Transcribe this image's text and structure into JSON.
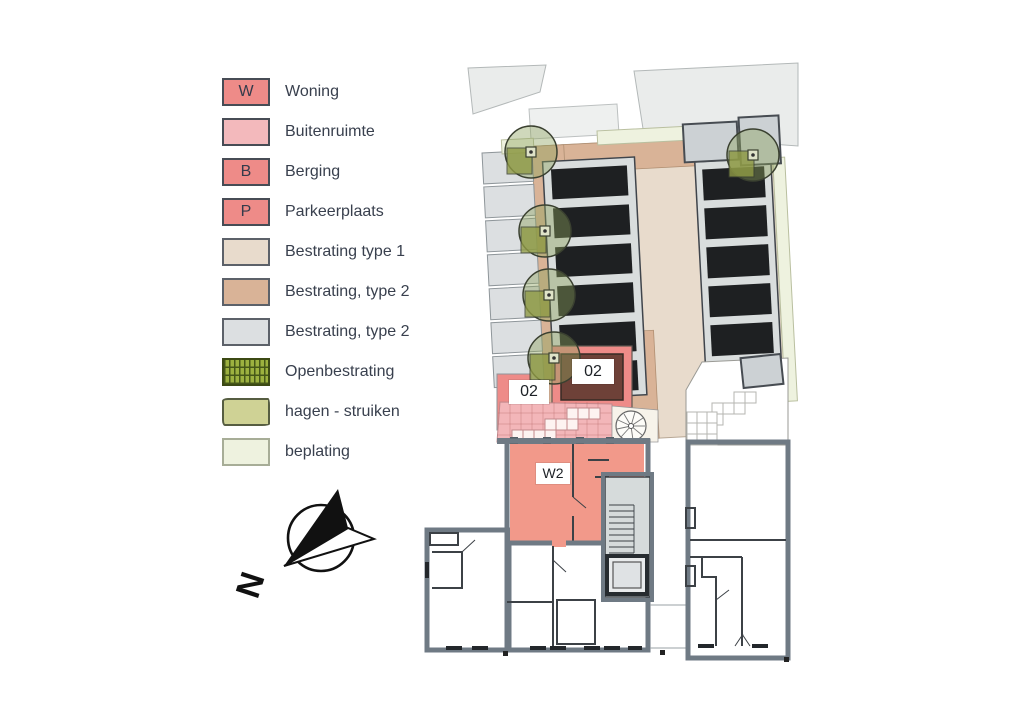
{
  "legend": {
    "items": [
      {
        "key": "W",
        "label": "Woning",
        "color": "#ee8b88"
      },
      {
        "key": "",
        "label": "Buitenruimte",
        "color": "#f3b9bc"
      },
      {
        "key": "B",
        "label": "Berging",
        "color": "#ee8b88"
      },
      {
        "key": "P",
        "label": "Parkeerplaats",
        "color": "#ee8b88"
      },
      {
        "key": "",
        "label": "Bestrating type 1",
        "color": "#e8dbcc"
      },
      {
        "key": "",
        "label": "Bestrating, type 2",
        "color": "#d9b397"
      },
      {
        "key": "",
        "label": "Bestrating, type 2",
        "color": "#dcdfe1"
      },
      {
        "key": "",
        "label": "Openbestrating",
        "color": "#9cb13f"
      },
      {
        "key": "",
        "label": "hagen - struiken",
        "color": "#cfd295"
      },
      {
        "key": "",
        "label": "beplating",
        "color": "#eef2df"
      }
    ]
  },
  "compass": {
    "north_label": "N"
  },
  "plan": {
    "labels": {
      "storage_unit": "02",
      "side_unit": "02",
      "apartment": "W2"
    },
    "colors": {
      "woning": "#ee8b88",
      "buitenruimte": "#f3b9bc",
      "bestrating_type1": "#e8dbcc",
      "bestrating_type2_tan": "#d9b397",
      "bestrating_type2_gray": "#dcdfe1",
      "openbestrating": "#9cb13f",
      "hagen_struiken": "#cfd295",
      "beplating": "#eef2df",
      "walls": "#6f7a84",
      "stalls": "#1e2022",
      "storage_inner": "#6e4138"
    },
    "counts": {
      "stall_rows_left": 6,
      "stall_rows_right": 6,
      "trees": 5,
      "gray_stripes": 7
    }
  }
}
